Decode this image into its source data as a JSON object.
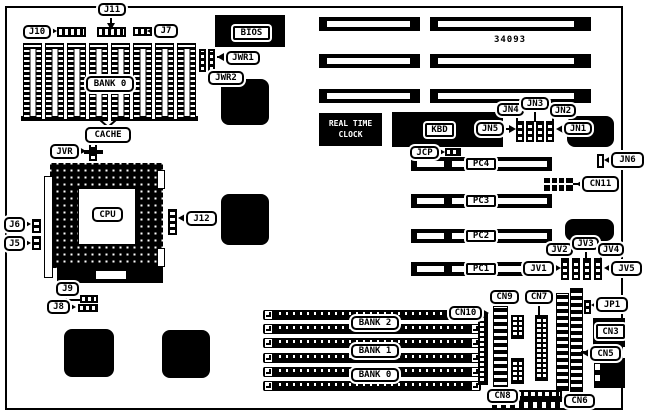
{
  "diagram_title": "motherboard-layout-diagram",
  "colors": {
    "ink": "#000000",
    "paper": "#ffffff"
  },
  "labels": {
    "j10": "J10",
    "j11": "J11",
    "j7": "J7",
    "jwr1": "JWR1",
    "jwr2": "JWR2",
    "bios": "BIOS",
    "bank0_dip": "BANK 0",
    "cache": "CACHE",
    "jvr": "JVR",
    "j6": "J6",
    "j5": "J5",
    "cpu": "CPU",
    "j12": "J12",
    "amp": "AMP",
    "j9": "J9",
    "j8": "J8",
    "rtc_line1": "REAL TIME",
    "rtc_line2": "CLOCK",
    "kbd": "KBD",
    "part_number": "34093",
    "jn1": "JN1",
    "jn2": "JN2",
    "jn3": "JN3",
    "jn4": "JN4",
    "jn5": "JN5",
    "jn6": "JN6",
    "jcp": "JCP",
    "cn11": "CN11",
    "pc1": "PC1",
    "pc2": "PC2",
    "pc3": "PC3",
    "pc4": "PC4",
    "jv1": "JV1",
    "jv2": "JV2",
    "jv3": "JV3",
    "jv4": "JV4",
    "jv5": "JV5",
    "bank2": "BANK 2",
    "bank1": "BANK 1",
    "bank0": "BANK 0",
    "cn10": "CN10",
    "cn9": "CN9",
    "cn7": "CN7",
    "jp1": "JP1",
    "cn3": "CN3",
    "cn5": "CN5",
    "cn8": "CN8",
    "cn6": "CN6"
  }
}
